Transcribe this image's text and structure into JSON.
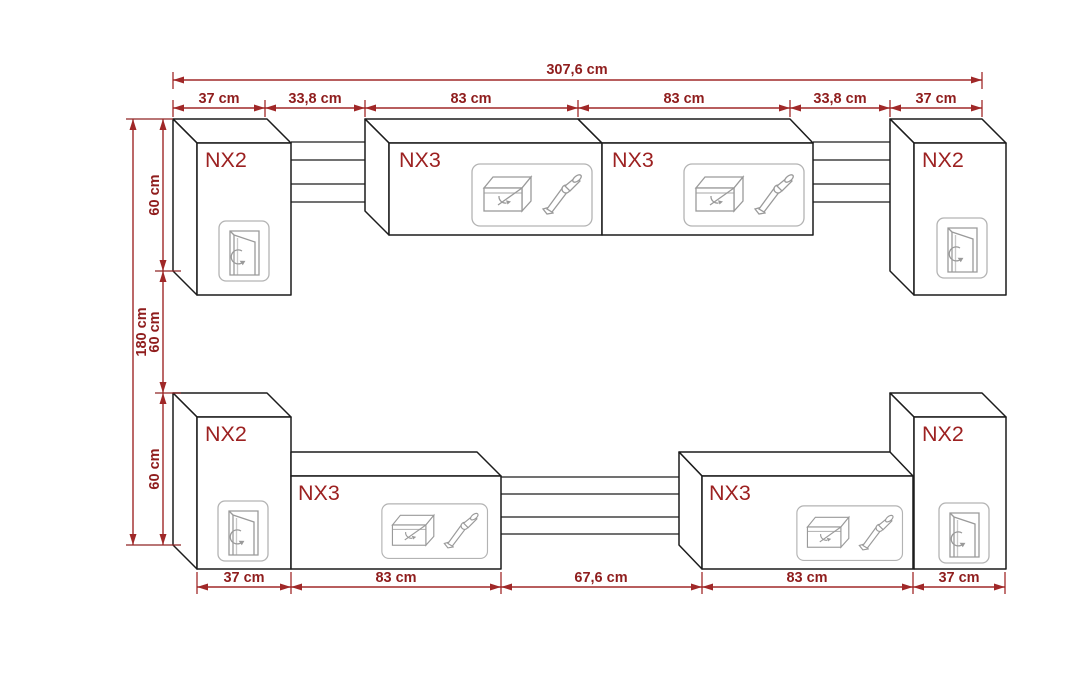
{
  "diagram": {
    "type": "furniture-wall-unit-dimension-drawing",
    "units": "cm",
    "rows": 2
  },
  "colors": {
    "background": "#ffffff",
    "dimension_line": "#a02828",
    "dimension_text": "#8f1d1d",
    "cabinet_outline": "#1c1c1c",
    "cabinet_label_text": "#9c2121",
    "icon_stroke": "#9a9a9a"
  },
  "dimensions": {
    "top_total": "307,6 cm",
    "top_segments": [
      "37 cm",
      "33,8 cm",
      "83 cm",
      "83 cm",
      "33,8 cm",
      "37 cm"
    ],
    "left_total": "180 cm",
    "left_segments": [
      "60 cm",
      "60 cm",
      "60 cm"
    ],
    "bottom_segments": [
      "37 cm",
      "83 cm",
      "67,6 cm",
      "83 cm",
      "37 cm"
    ]
  },
  "cabinets": {
    "top_left": {
      "label": "NX2",
      "icon": "hinged-door-icon"
    },
    "top_mid_left": {
      "label": "NX3",
      "icon": "flap-door-stay-arm-icon"
    },
    "top_mid_right": {
      "label": "NX3",
      "icon": "flap-door-stay-arm-icon"
    },
    "top_right": {
      "label": "NX2",
      "icon": "hinged-door-icon"
    },
    "bottom_left": {
      "label": "NX2",
      "icon": "hinged-door-icon"
    },
    "bottom_mid_left": {
      "label": "NX3",
      "icon": "flap-door-stay-arm-icon"
    },
    "bottom_mid_right": {
      "label": "NX3",
      "icon": "flap-door-stay-arm-icon"
    },
    "bottom_right": {
      "label": "NX2",
      "icon": "hinged-door-icon"
    }
  }
}
